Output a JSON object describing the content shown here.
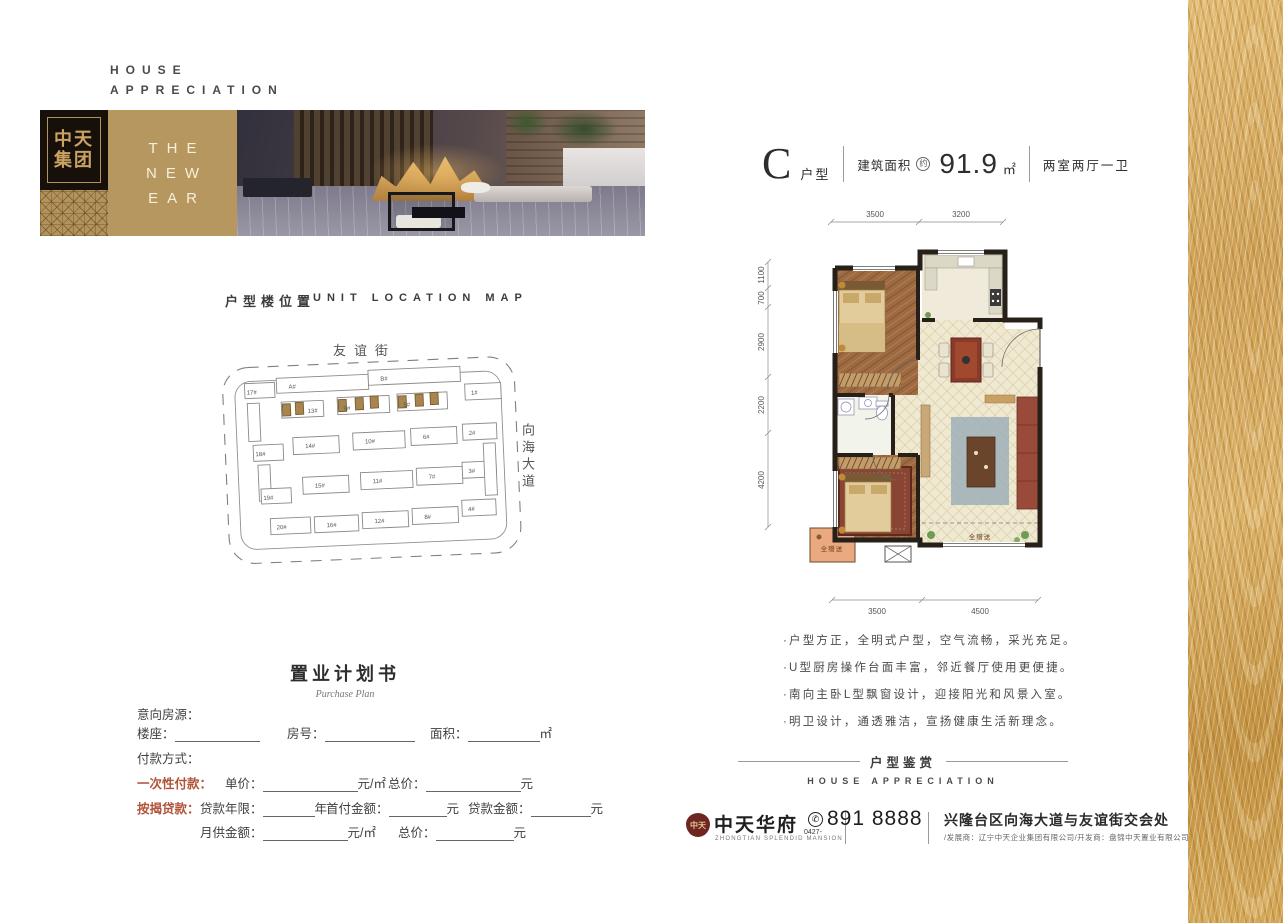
{
  "colors": {
    "gold": "#b3935c",
    "dark_logo": "#17100a",
    "accent_red": "#b0543a",
    "wall": "#262019",
    "gift_orange": "#eaa97e"
  },
  "header": {
    "line1": "HOUSE",
    "line2": "APPRECIATION"
  },
  "brand_block": {
    "logo_line1": "中天",
    "logo_line2": "集团",
    "banner_line1": "THE",
    "banner_line2": "NEW",
    "banner_line3": "EAR"
  },
  "location_map": {
    "title_cn": "户型楼位置",
    "title_en": "UNIT LOCATION MAP",
    "street_top": "友谊街",
    "street_right": "向海大道",
    "buildings": {
      "a": "A#",
      "b": "B#",
      "b1": "1#",
      "b2": "2#",
      "b3": "3#",
      "b4": "4#",
      "b5": "5#",
      "b6": "6#",
      "b7": "7#",
      "b8": "8#",
      "b9": "9#",
      "b10": "10#",
      "b11": "11#",
      "b12": "12#",
      "b13": "13#",
      "b14": "14#",
      "b15": "15#",
      "b16": "16#",
      "b17": "17#",
      "b18": "18#",
      "b19": "19#",
      "b20": "20#"
    }
  },
  "unit": {
    "letter": "C",
    "type_label": "户型",
    "area_label": "建筑面积",
    "area_approx": "约",
    "area_value": "91.9",
    "area_unit": "㎡",
    "rooms": "两室两厅一卫",
    "dims": {
      "top1": "3500",
      "top2": "3200",
      "left1": "1100",
      "left2": "700",
      "left3": "2900",
      "left4": "2200",
      "left5": "4200",
      "bottom1": "3500",
      "bottom2": "4500"
    },
    "gift1": "全赠送",
    "gift2": "全赠送",
    "features": [
      "·户型方正，全明式户型，空气流畅，采光充足。",
      "·U型厨房操作台面丰富，邻近餐厅使用更便捷。",
      "·南向主卧L型飘窗设计，迎接阳光和风景入室。",
      "·明卫设计，通透雅洁，宣扬健康生活新理念。"
    ],
    "section_cn": "户型鉴赏",
    "section_en": "HOUSE APPRECIATION"
  },
  "plan_form": {
    "title": "置业计划书",
    "subtitle": "Purchase Plan",
    "intent": "意向房源：",
    "building": "楼座：",
    "room": "房号：",
    "area": "面积：",
    "area_suffix": "㎡",
    "payment": "付款方式：",
    "onetime_label": "一次性付款：",
    "unit_price": "单价：",
    "per_sqm": "元/㎡",
    "total": "总价：",
    "yuan": "元",
    "mortgage_label": "按揭贷款：",
    "loan_years": "贷款年限：",
    "year": "年",
    "down_payment": "首付金额：",
    "loan_amount": "贷款金额：",
    "monthly": "月供金额："
  },
  "footer": {
    "seal": "中天",
    "brand": "中天华府",
    "brand_en": "ZHONGTIAN SPLENDID MANSION",
    "area_code": "0427-",
    "phone": "891 8888",
    "address": "兴隆台区向海大道与友谊街交会处",
    "companies": "/发展商：辽宁中天企业集团有限公司/开发商：盘锦中天置业有限公司"
  }
}
